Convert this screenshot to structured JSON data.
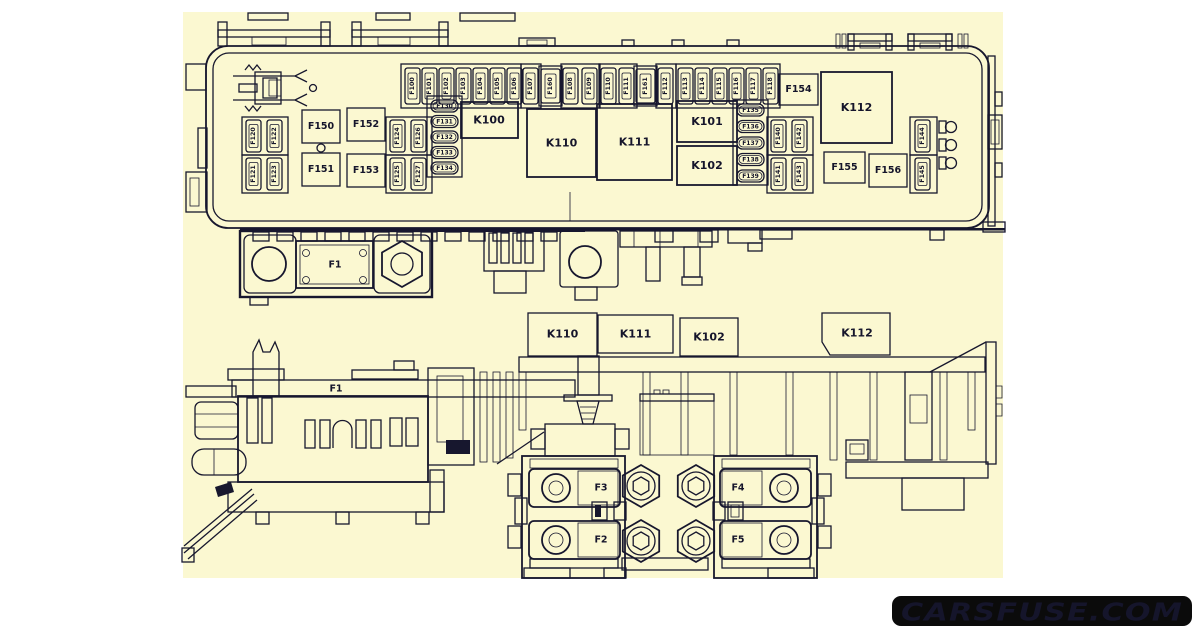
{
  "colors": {
    "page_bg": "#ffffff",
    "diagram_bg": "#fbf8d1",
    "line": "#17172e",
    "watermark_bg": "#0b0b0b",
    "watermark_text": "#ffffff"
  },
  "watermark": {
    "text": "CARSFUSE.COM"
  },
  "top_view": {
    "fuse_row": [
      "F100",
      "F101",
      "F102",
      "F103",
      "F104",
      "F105",
      "F106",
      "F107",
      "F160",
      "F108",
      "F109",
      "F110",
      "F111",
      "F161",
      "F112",
      "F113",
      "F114",
      "F115",
      "F116",
      "F117",
      "F118"
    ],
    "grid_left": [
      "F120",
      "F122",
      "F121",
      "F123"
    ],
    "grid_mid": [
      "F124",
      "F126",
      "F125",
      "F127"
    ],
    "grid_right": [
      "F140",
      "F142",
      "F141",
      "F143"
    ],
    "column_right": [
      "F144",
      "F145"
    ],
    "mini_left": [
      "F130",
      "F131",
      "F132",
      "F133",
      "F134"
    ],
    "mini_right": [
      "F135",
      "F136",
      "F137",
      "F138",
      "F139"
    ],
    "relays": {
      "k100": "K100",
      "k110": "K110",
      "k111": "K111",
      "k101": "K101",
      "k102": "K102",
      "k112": "K112"
    },
    "fuse_boxes": {
      "f150": "F150",
      "f151": "F151",
      "f152": "F152",
      "f153": "F153",
      "f154": "F154",
      "f155": "F155",
      "f156": "F156"
    },
    "mega_fuse": "F1"
  },
  "side_view": {
    "relays": {
      "k110": "K110",
      "k111": "K111",
      "k102": "K102",
      "k112": "K112"
    },
    "mega_fuse": "F1",
    "midi_fuses": {
      "f2": "F2",
      "f3": "F3",
      "f4": "F4",
      "f5": "F5"
    }
  }
}
